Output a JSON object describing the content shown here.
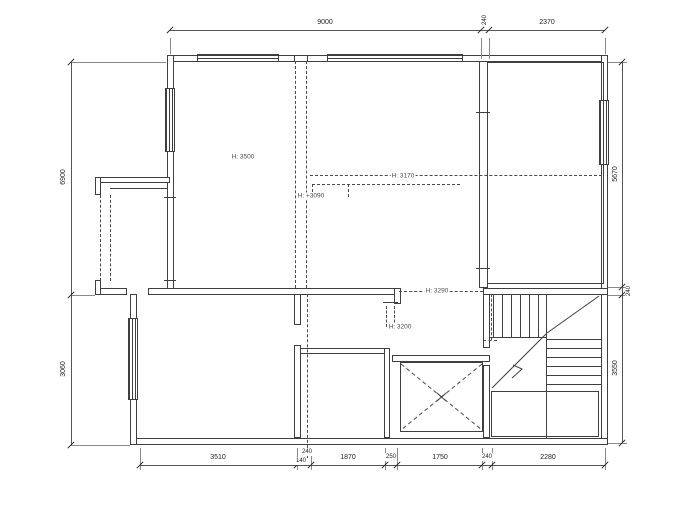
{
  "plan": {
    "dims_top": {
      "d1": "9000",
      "d2": "240",
      "d3": "2370"
    },
    "dims_bottom": {
      "d1": "3510",
      "d2a": "240",
      "d2b": "140",
      "d3": "1870",
      "d4": "250",
      "d5": "1750",
      "d6": "240",
      "d7": "2280"
    },
    "dims_left": {
      "d1": "6900",
      "d2": "3060"
    },
    "dims_right": {
      "d1": "5670",
      "d2": "240",
      "d3": "3550"
    },
    "height_labels": {
      "room_left": "H: 3500",
      "level_3090": "H: +3090",
      "level_3170": "H: 3170",
      "level_3290": "H: 3290",
      "level_3200": "H: 3200"
    },
    "line_color": "#3f3f3f"
  }
}
